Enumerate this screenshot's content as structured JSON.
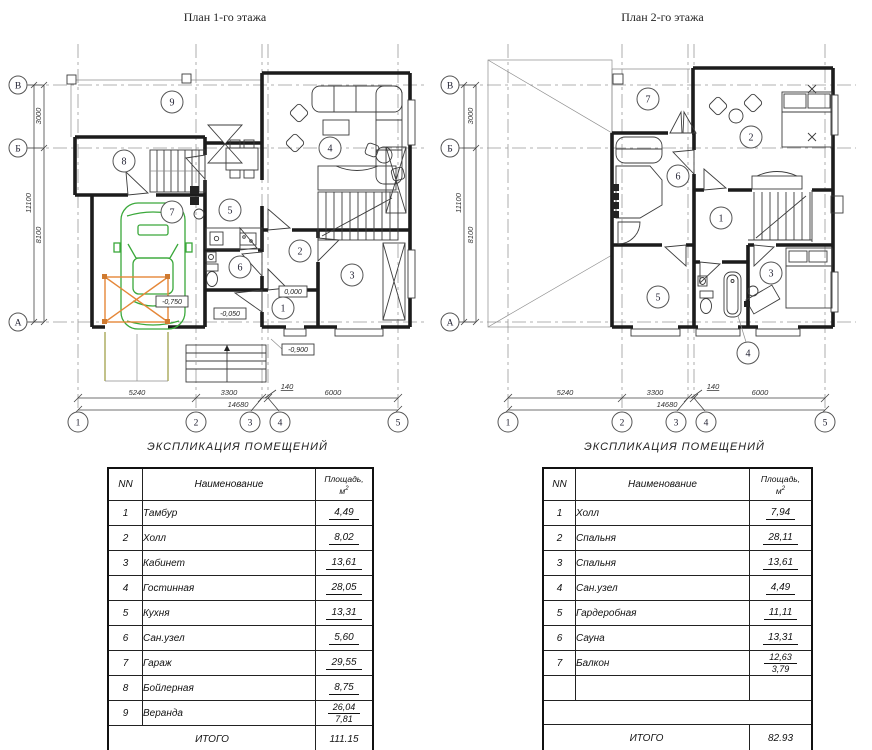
{
  "plan1": {
    "title": "План 1-го этажа",
    "rooms": [
      "1",
      "2",
      "3",
      "4",
      "5",
      "6",
      "7",
      "8",
      "9"
    ],
    "axes_letters": [
      "В",
      "Б",
      "А"
    ],
    "axes_numbers": [
      "1",
      "2",
      "3",
      "4",
      "5"
    ],
    "dims": {
      "d5240": "5240",
      "d3300": "3300",
      "d140": "140",
      "d6000": "6000",
      "total": "14680",
      "v3000": "3000",
      "v8100": "8100",
      "vtotal": "11100"
    },
    "elevations": {
      "garage": "-0,750",
      "entry": "0,000",
      "porch": "-0,050",
      "ground": "-0,900"
    }
  },
  "plan2": {
    "title": "План 2-го этажа",
    "rooms": [
      "1",
      "2",
      "3",
      "4",
      "5",
      "6",
      "7"
    ],
    "axes_letters": [
      "В",
      "Б",
      "А"
    ],
    "axes_numbers": [
      "1",
      "2",
      "3",
      "4",
      "5"
    ],
    "dims": {
      "d5240": "5240",
      "d3300": "3300",
      "d140": "140",
      "d6000": "6000",
      "total": "14680",
      "v3000": "3000",
      "v8100": "8100",
      "vtotal": "11100"
    }
  },
  "table1": {
    "caption": "ЭКСПЛИКАЦИЯ  ПОМЕЩЕНИЙ",
    "col_nn": "NN",
    "col_name": "Наименование",
    "col_area_line1": "Площадь,",
    "col_area_base": "м",
    "col_area_sup": "2",
    "rows": [
      {
        "nn": "1",
        "name": "Тамбур",
        "area": "4,49"
      },
      {
        "nn": "2",
        "name": "Холл",
        "area": "8,02"
      },
      {
        "nn": "3",
        "name": "Кабинет",
        "area": "13,61"
      },
      {
        "nn": "4",
        "name": "Гостинная",
        "area": "28,05"
      },
      {
        "nn": "5",
        "name": "Кухня",
        "area": "13,31"
      },
      {
        "nn": "6",
        "name": "Сан.узел",
        "area": "5,60"
      },
      {
        "nn": "7",
        "name": "Гараж",
        "area": "29,55"
      },
      {
        "nn": "8",
        "name": "Бойлерная",
        "area": "8,75"
      },
      {
        "nn": "9",
        "name": "Веранда",
        "area": "26,04",
        "area2": "7,81"
      }
    ],
    "total_label": "ИТОГО",
    "total_value": "111.15"
  },
  "table2": {
    "caption": "ЭКСПЛИКАЦИЯ  ПОМЕЩЕНИЙ",
    "col_nn": "NN",
    "col_name": "Наименование",
    "col_area_line1": "Площадь,",
    "col_area_base": "м",
    "col_area_sup": "2",
    "rows": [
      {
        "nn": "1",
        "name": "Холл",
        "area": "7,94"
      },
      {
        "nn": "2",
        "name": "Спальня",
        "area": "28,11"
      },
      {
        "nn": "3",
        "name": "Спальня",
        "area": "13,61"
      },
      {
        "nn": "4",
        "name": "Сан.узел",
        "area": "4,49"
      },
      {
        "nn": "5",
        "name": "Гардеробная",
        "area": "11,11"
      },
      {
        "nn": "6",
        "name": "Сауна",
        "area": "13,31"
      },
      {
        "nn": "7",
        "name": "Балкон",
        "area": "12,63",
        "area2": "3,79"
      }
    ],
    "total_label": "ИТОГО",
    "total_value": "82.93"
  }
}
